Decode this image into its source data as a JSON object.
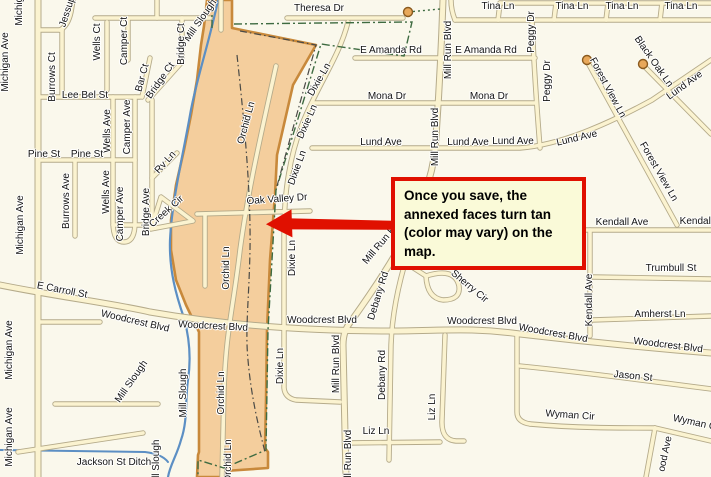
{
  "callout": {
    "text": "Once you save, the annexed faces turn tan (color may vary) on the map."
  },
  "colors": {
    "background": "#FAF8EC",
    "road_fill": "#FBF3D0",
    "road_casing": "#B5AB8B",
    "annexed_fill": "#F4CE9D",
    "annexed_border": "#C8893B",
    "water": "#5C8FC4",
    "boundary_green": "#3E6B41",
    "inner_dash": "#4A4A46",
    "culdesac_fill": "#E8A85A",
    "accent_red": "#E01000",
    "callout_bg": "#FAFAD8"
  },
  "street_labels": [
    {
      "t": "Theresa Dr",
      "x": 319,
      "y": 9,
      "r": 0
    },
    {
      "t": "Tina Ln",
      "x": 498,
      "y": 7,
      "r": 0
    },
    {
      "t": "Tina Ln",
      "x": 572,
      "y": 7,
      "r": 0
    },
    {
      "t": "Tina Ln",
      "x": 622,
      "y": 7,
      "r": 0
    },
    {
      "t": "Tina Ln",
      "x": 681,
      "y": 7,
      "r": 0
    },
    {
      "t": "Mill Run Blvd",
      "x": 449,
      "y": 50,
      "r": -90
    },
    {
      "t": "Mill Run Blvd",
      "x": 436,
      "y": 137,
      "r": -90
    },
    {
      "t": "E Amanda Rd",
      "x": 391,
      "y": 51,
      "r": 0
    },
    {
      "t": "E Amanda Rd",
      "x": 486,
      "y": 51,
      "r": 0
    },
    {
      "t": "Peggy Dr",
      "x": 532,
      "y": 32,
      "r": -90
    },
    {
      "t": "Peggy Dr",
      "x": 548,
      "y": 81,
      "r": -90
    },
    {
      "t": "Black Oak Ln",
      "x": 653,
      "y": 62,
      "r": 55
    },
    {
      "t": "Forest View Ln",
      "x": 607,
      "y": 88,
      "r": 62
    },
    {
      "t": "Forest View Ln",
      "x": 658,
      "y": 172,
      "r": 60
    },
    {
      "t": "Lund Ave",
      "x": 685,
      "y": 86,
      "r": -36
    },
    {
      "t": "Mona Dr",
      "x": 387,
      "y": 97,
      "r": 0
    },
    {
      "t": "Mona Dr",
      "x": 489,
      "y": 97,
      "r": 0
    },
    {
      "t": "Lund Ave",
      "x": 381,
      "y": 143,
      "r": 0
    },
    {
      "t": "Lund Ave",
      "x": 468,
      "y": 143,
      "r": 0
    },
    {
      "t": "Lund Ave",
      "x": 513,
      "y": 142,
      "r": 0
    },
    {
      "t": "Lund Ave",
      "x": 577,
      "y": 139,
      "r": -13
    },
    {
      "t": "Dixie Ln",
      "x": 320,
      "y": 80,
      "r": -60
    },
    {
      "t": "Dixie Ln",
      "x": 308,
      "y": 122,
      "r": -66
    },
    {
      "t": "Dixie Ln",
      "x": 298,
      "y": 168,
      "r": -70
    },
    {
      "t": "Dixie Ln",
      "x": 293,
      "y": 258,
      "r": -90
    },
    {
      "t": "Dixie Ln",
      "x": 281,
      "y": 366,
      "r": -90
    },
    {
      "t": "Mill Slough",
      "x": 201,
      "y": 21,
      "r": -55
    },
    {
      "t": "Orchid Ln",
      "x": 247,
      "y": 123,
      "r": -75
    },
    {
      "t": "Orchid Ln",
      "x": 227,
      "y": 268,
      "r": -90
    },
    {
      "t": "Orchid Ln",
      "x": 222,
      "y": 393,
      "r": -90
    },
    {
      "t": "Orchid Ln",
      "x": 229,
      "y": 461,
      "r": -90
    },
    {
      "t": "Oak Valley Dr",
      "x": 277,
      "y": 200,
      "r": -4
    },
    {
      "t": "Mill Run Blvd",
      "x": 384,
      "y": 241,
      "r": -50
    },
    {
      "t": "Mill Run Blvd",
      "x": 337,
      "y": 364,
      "r": -90
    },
    {
      "t": "Mill Run Blvd",
      "x": 349,
      "y": 459,
      "r": -90
    },
    {
      "t": "Sherry Cir",
      "x": 469,
      "y": 287,
      "r": 40
    },
    {
      "t": "Debany Rd",
      "x": 379,
      "y": 296,
      "r": -73
    },
    {
      "t": "Debany Rd",
      "x": 383,
      "y": 375,
      "r": -90
    },
    {
      "t": "Kendall Ave",
      "x": 622,
      "y": 223,
      "r": 0
    },
    {
      "t": "Kendall Ave",
      "x": 706,
      "y": 222,
      "r": 0
    },
    {
      "t": "Kendall Ave",
      "x": 590,
      "y": 300,
      "r": -90
    },
    {
      "t": "Trumbull St",
      "x": 671,
      "y": 269,
      "r": 0
    },
    {
      "t": "Amherst Ln",
      "x": 660,
      "y": 315,
      "r": 0
    },
    {
      "t": "E Carroll St",
      "x": 62,
      "y": 291,
      "r": 11
    },
    {
      "t": "Woodcrest Blvd",
      "x": 135,
      "y": 322,
      "r": 13
    },
    {
      "t": "Woodcrest Blvd",
      "x": 213,
      "y": 327,
      "r": 3
    },
    {
      "t": "Woodcrest Blvd",
      "x": 322,
      "y": 321,
      "r": 0
    },
    {
      "t": "Woodcrest Blvd",
      "x": 482,
      "y": 322,
      "r": 0
    },
    {
      "t": "Woodcrest Blvd",
      "x": 553,
      "y": 334,
      "r": 10
    },
    {
      "t": "Woodcrest Blvd",
      "x": 668,
      "y": 346,
      "r": 7
    },
    {
      "t": "Jason St",
      "x": 633,
      "y": 377,
      "r": 6
    },
    {
      "t": "Wyman Cir",
      "x": 570,
      "y": 416,
      "r": 4
    },
    {
      "t": "Wyman Cir",
      "x": 697,
      "y": 424,
      "r": 12
    },
    {
      "t": "ood Ave",
      "x": 666,
      "y": 454,
      "r": -78
    },
    {
      "t": "Liz Ln",
      "x": 376,
      "y": 432,
      "r": 0
    },
    {
      "t": "Liz Ln",
      "x": 433,
      "y": 407,
      "r": -90
    },
    {
      "t": "Jackson St Ditch",
      "x": 114,
      "y": 463,
      "r": 0
    },
    {
      "t": "Mill Slough",
      "x": 132,
      "y": 382,
      "r": -55
    },
    {
      "t": "Mill Slough",
      "x": 184,
      "y": 393,
      "r": -90
    },
    {
      "t": "Mill Slough",
      "x": 157,
      "y": 464,
      "r": -90
    },
    {
      "t": "Michigan Ave",
      "x": 20,
      "y": -4,
      "r": -90
    },
    {
      "t": "Michigan Ave",
      "x": 6,
      "y": 62,
      "r": -90
    },
    {
      "t": "Michigan Ave",
      "x": 21,
      "y": 225,
      "r": -90
    },
    {
      "t": "Michigan Ave",
      "x": 10,
      "y": 350,
      "r": -90
    },
    {
      "t": "Michigan Ave",
      "x": 10,
      "y": 437,
      "r": -90
    },
    {
      "t": "Jessup",
      "x": 68,
      "y": 12,
      "r": -72
    },
    {
      "t": "Burrows Ct",
      "x": 53,
      "y": 77,
      "r": -90
    },
    {
      "t": "Burrows Ave",
      "x": 67,
      "y": 201,
      "r": -90
    },
    {
      "t": "Wells Ct",
      "x": 98,
      "y": 42,
      "r": -90
    },
    {
      "t": "Wells Ave",
      "x": 108,
      "y": 131,
      "r": -90
    },
    {
      "t": "Wells Ave",
      "x": 107,
      "y": 192,
      "r": -90
    },
    {
      "t": "Camper Ct",
      "x": 125,
      "y": 41,
      "r": -90
    },
    {
      "t": "Camper Ave",
      "x": 128,
      "y": 127,
      "r": -90
    },
    {
      "t": "Camper Ave",
      "x": 121,
      "y": 214,
      "r": -90
    },
    {
      "t": "Bar Ct",
      "x": 143,
      "y": 78,
      "r": -75
    },
    {
      "t": "Bridge Ct",
      "x": 182,
      "y": 44,
      "r": -90
    },
    {
      "t": "Bridge Ct",
      "x": 161,
      "y": 81,
      "r": -55
    },
    {
      "t": "Bridge Ave",
      "x": 147,
      "y": 212,
      "r": -90
    },
    {
      "t": "Rv Ln",
      "x": 166,
      "y": 163,
      "r": -48
    },
    {
      "t": "Creek Cir",
      "x": 167,
      "y": 212,
      "r": -42
    },
    {
      "t": "Lee Bel St",
      "x": 85,
      "y": 96,
      "r": 0
    },
    {
      "t": "Pine St",
      "x": 44,
      "y": 155,
      "r": 0
    },
    {
      "t": "Pine St",
      "x": 87,
      "y": 155,
      "r": 0
    }
  ]
}
